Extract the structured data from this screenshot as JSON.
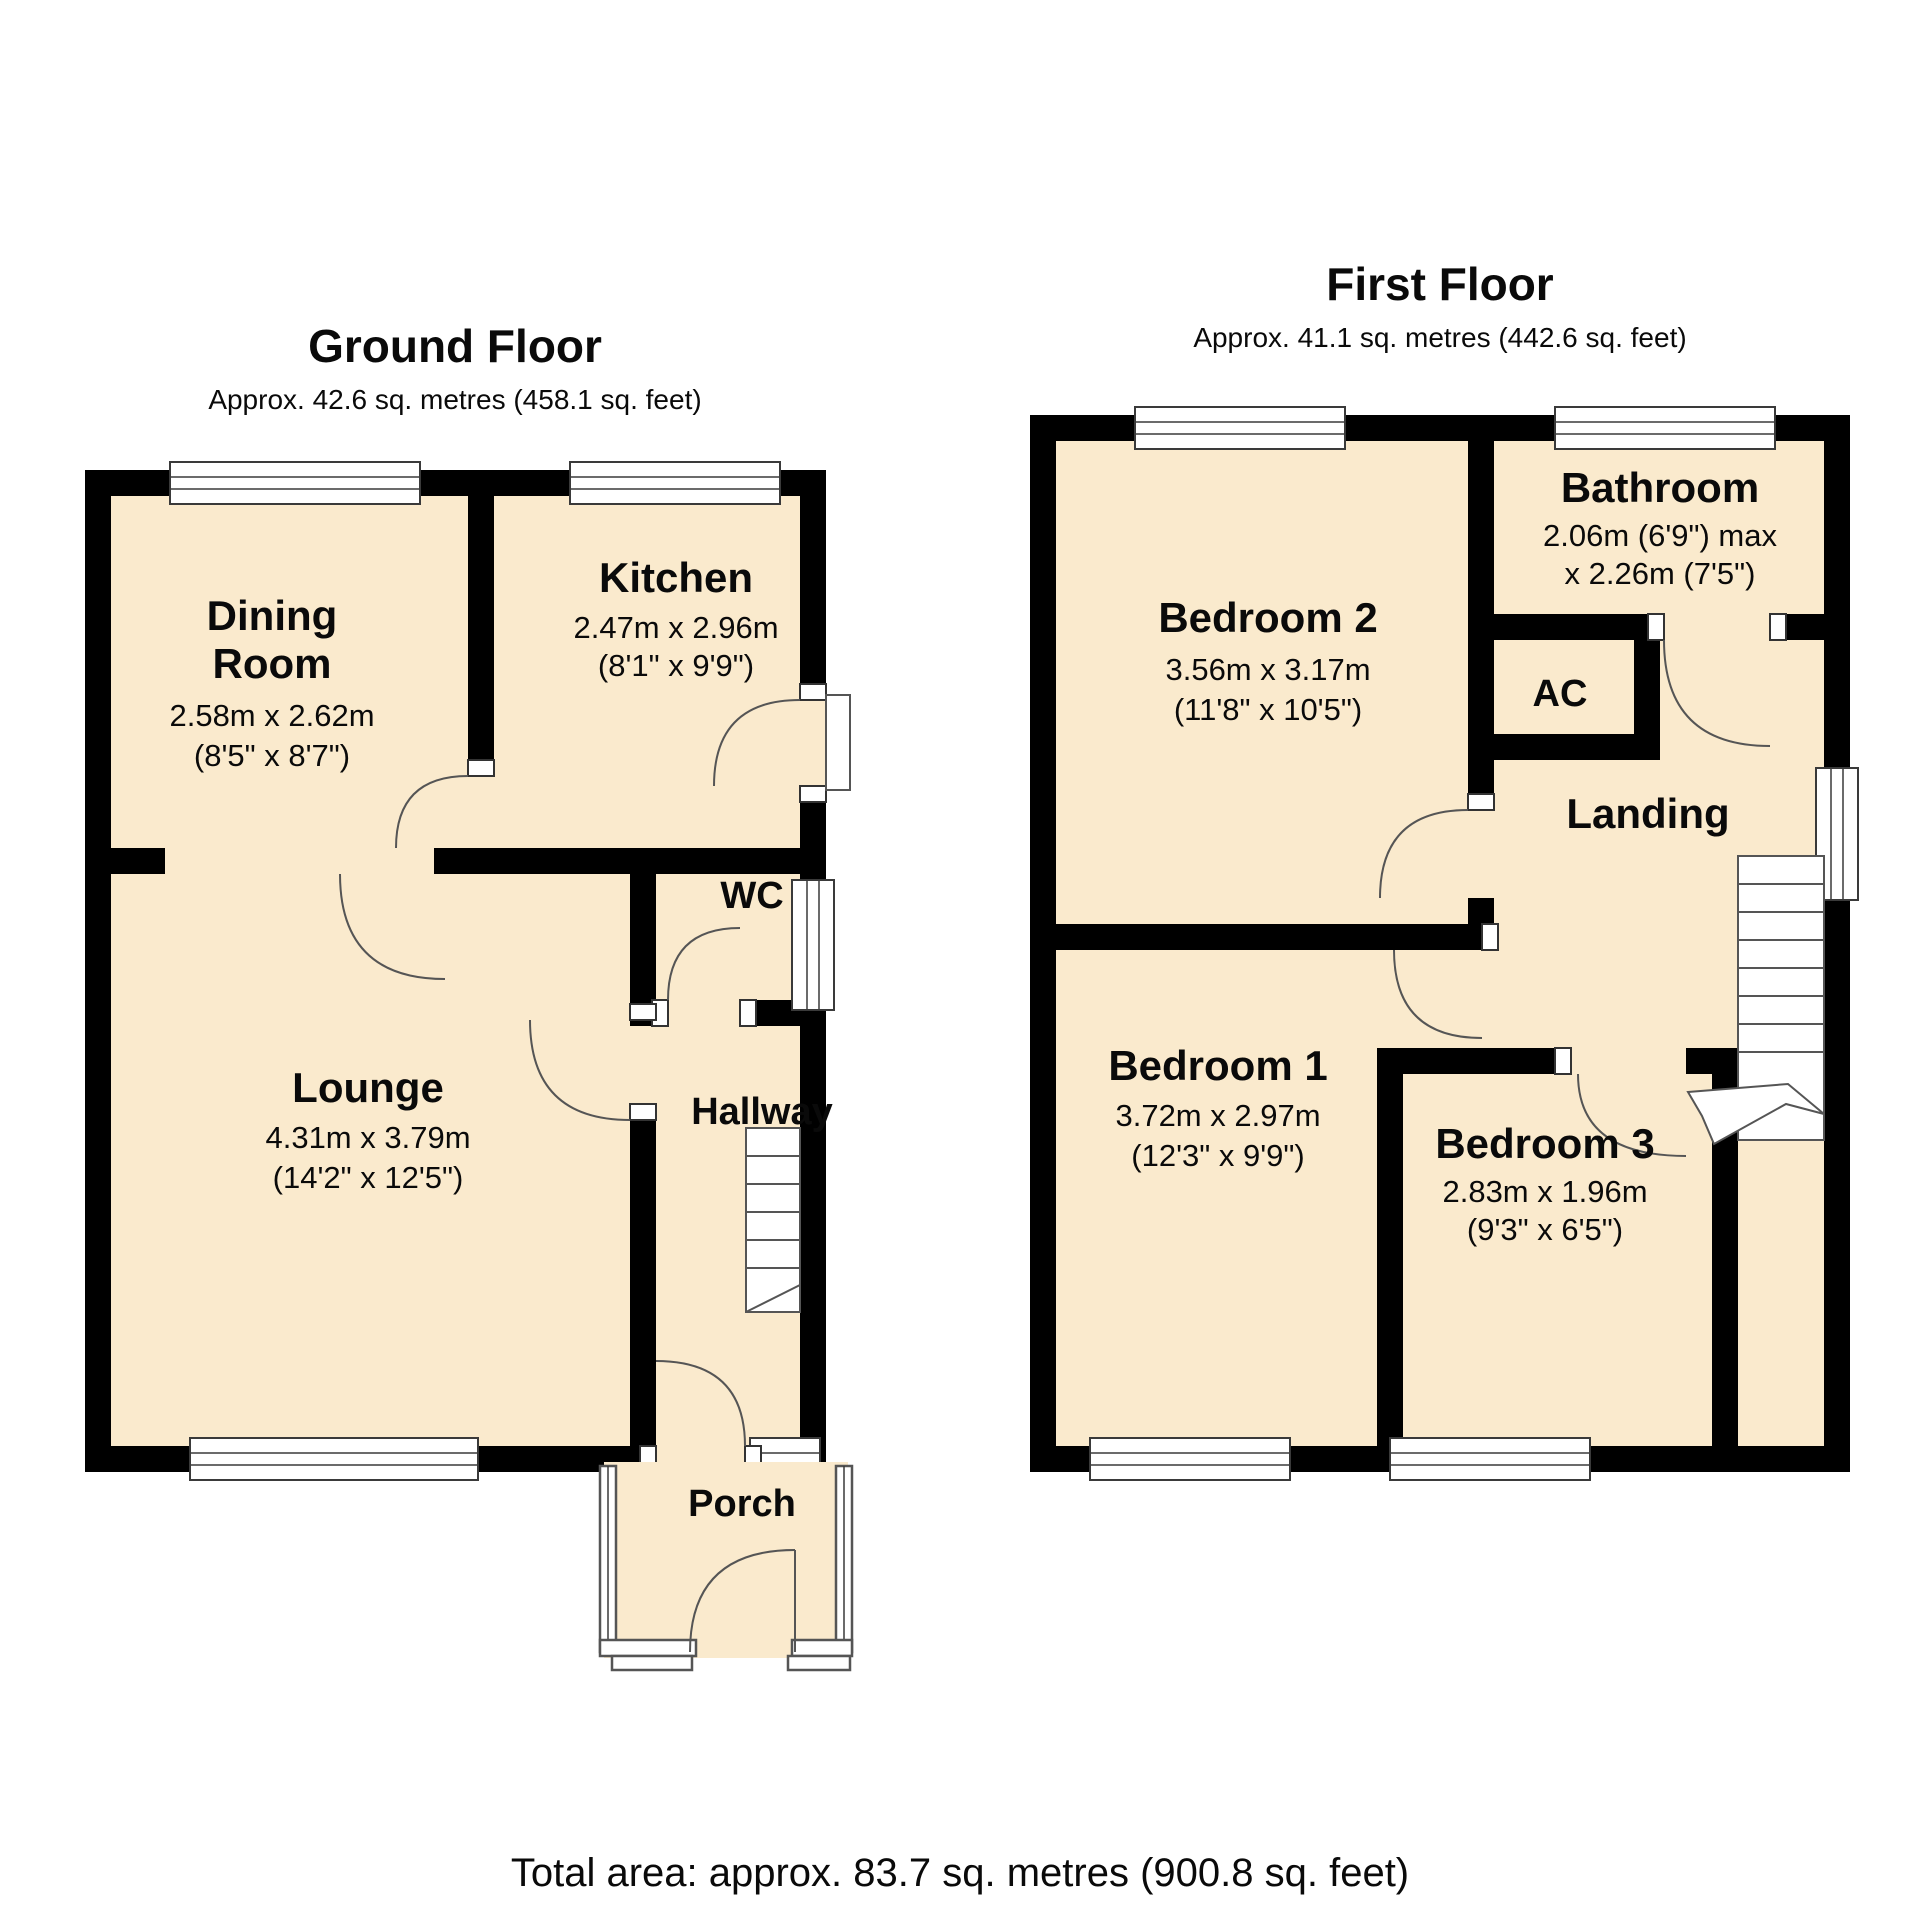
{
  "ground_floor": {
    "title": "Ground Floor",
    "subtitle": "Approx. 42.6 sq. metres (458.1 sq. feet)",
    "rooms": {
      "dining": {
        "line1": "Dining",
        "line2": "Room",
        "dims_m": "2.58m x 2.62m",
        "dims_ft": "(8'5\" x 8'7\")"
      },
      "kitchen": {
        "name": "Kitchen",
        "dims_m": "2.47m x 2.96m",
        "dims_ft": "(8'1\" x 9'9\")"
      },
      "lounge": {
        "name": "Lounge",
        "dims_m": "4.31m x 3.79m",
        "dims_ft": "(14'2\" x 12'5\")"
      },
      "wc": {
        "name": "WC"
      },
      "hallway": {
        "name": "Hallway"
      },
      "porch": {
        "name": "Porch"
      }
    }
  },
  "first_floor": {
    "title": "First Floor",
    "subtitle": "Approx. 41.1 sq. metres (442.6 sq. feet)",
    "rooms": {
      "bedroom2": {
        "name": "Bedroom 2",
        "dims_m": "3.56m x 3.17m",
        "dims_ft": "(11'8\" x 10'5\")"
      },
      "bathroom": {
        "name": "Bathroom",
        "dims_m": "2.06m (6'9\") max",
        "dims_ft": "x 2.26m (7'5\")"
      },
      "ac": {
        "name": "AC"
      },
      "landing": {
        "name": "Landing"
      },
      "bedroom1": {
        "name": "Bedroom 1",
        "dims_m": "3.72m x 2.97m",
        "dims_ft": "(12'3\" x 9'9\")"
      },
      "bedroom3": {
        "name": "Bedroom 3",
        "dims_m": "2.83m x 1.96m",
        "dims_ft": "(9'3\" x 6'5\")"
      }
    }
  },
  "footer": {
    "total_area": "Total area: approx. 83.7 sq. metres (900.8 sq. feet)"
  },
  "colors": {
    "floor_fill": "#FAEACD",
    "wall": "#000000"
  }
}
